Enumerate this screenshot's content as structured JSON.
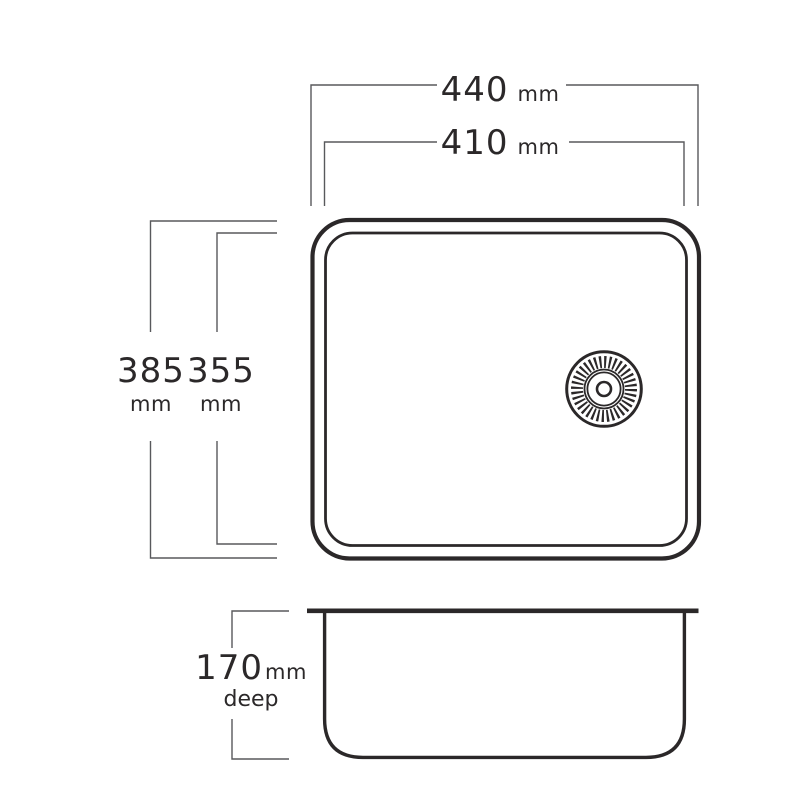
{
  "drawing_type": "sink technical dimension drawing",
  "colors": {
    "background": "#ffffff",
    "outline": "#2b2829",
    "dimension_line": "#58595c",
    "text": "#2b2829"
  },
  "icons": {
    "drain": "drain-icon"
  },
  "dimensions": {
    "outer_width": {
      "value": "440",
      "unit": "mm"
    },
    "inner_width": {
      "value": "410",
      "unit": "mm"
    },
    "outer_length": {
      "value": "385",
      "unit": "mm"
    },
    "inner_length": {
      "value": "355",
      "unit": "mm"
    },
    "depth": {
      "value": "170",
      "unit": "mm",
      "word": "deep"
    }
  }
}
